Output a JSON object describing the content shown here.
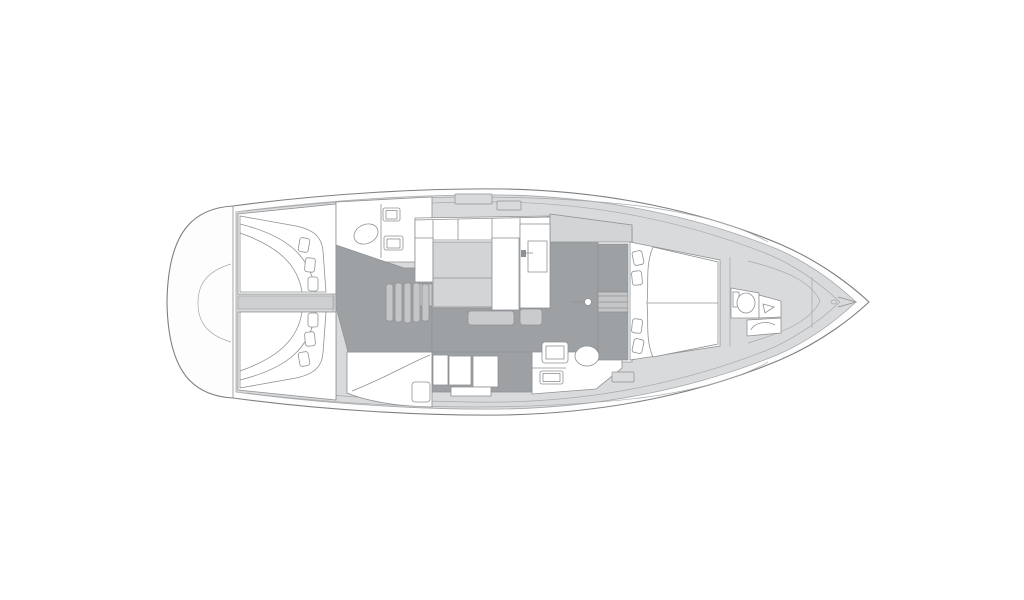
{
  "diagram": {
    "type": "sailing-yacht-interior-floor-plan",
    "orientation": "bow-right-stern-left",
    "text_labels": []
  },
  "colors": {
    "background": "#ffffff",
    "hull-fill": "#fdfdfd",
    "deck-fill": "#d9dadb",
    "floor-dark": "#9ea1a4",
    "furniture-white": "#ffffff",
    "table-fill": "#d2d4d5",
    "stairs-fill": "#c3c5c7",
    "locker-fill": "#c9cbcd",
    "corridor-fill": "#cdcfd1",
    "line": "#8e9194",
    "line-light": "#a6a9ac",
    "line-dark": "#7d8083"
  },
  "features": [
    "swim-platform",
    "transom-garage",
    "engine-corridor",
    "port-aft-cabin",
    "port-aft-cabin-bed",
    "starboard-aft-cabin",
    "starboard-aft-cabin-bed",
    "port-aft-head",
    "toilet",
    "twin-sinks",
    "companionway-stairs",
    "galley-counters",
    "galley-drawer",
    "salon-table",
    "port-settee",
    "starboard-settee",
    "nav-station",
    "sideboard",
    "starboard-aft-head",
    "shower-bench",
    "mast",
    "wardrobes",
    "steps",
    "forward-cabin",
    "forward-berth",
    "pillows",
    "forward-head",
    "forward-toilet",
    "forward-sink",
    "forward-shower-seat",
    "anchor-locker",
    "bow"
  ]
}
